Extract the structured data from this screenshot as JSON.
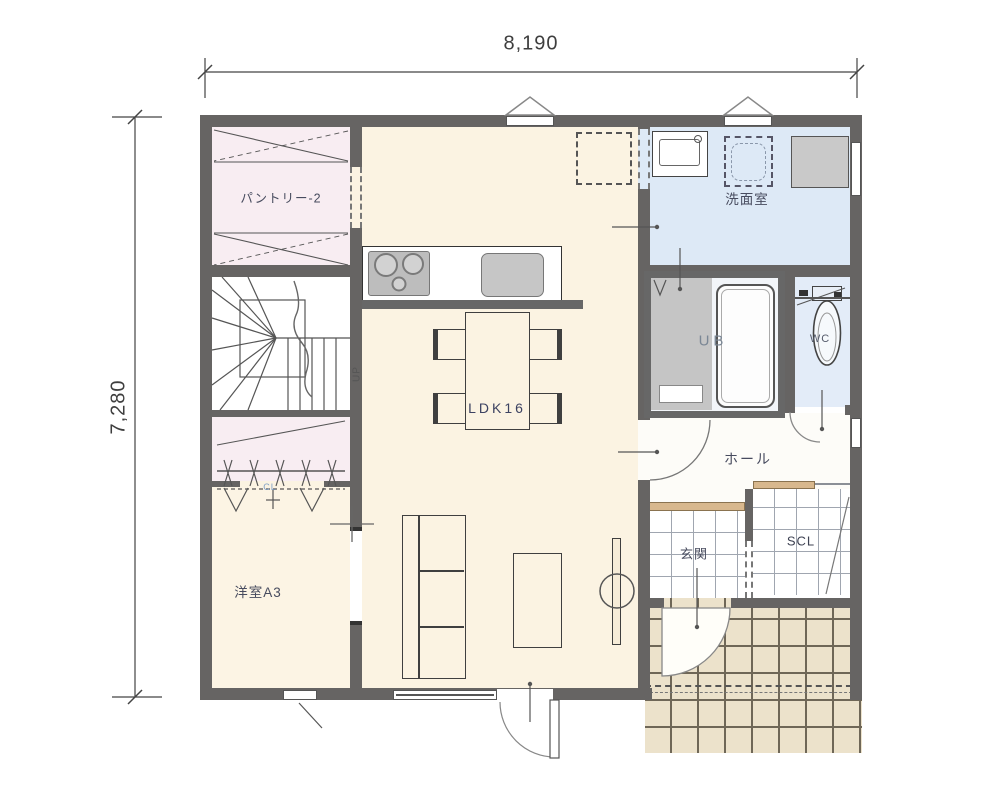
{
  "plan": {
    "dimensions": {
      "width_label": "8,190",
      "height_label": "7,280"
    },
    "labels": {
      "pantry": "パントリー-2",
      "up": "UP",
      "cl": "CL",
      "bedroom": "洋室A3",
      "ldk": "LDK16",
      "washroom": "洗面室",
      "bath": "UB",
      "wc": "WC",
      "hall": "ホール",
      "entrance": "玄関",
      "shoe_closet": "SCL"
    },
    "colors": {
      "wall": "#666463",
      "ldk_floor": "#fbf3e2",
      "bedroom_floor": "#fcf4e4",
      "pantry_floor": "#f8edf2",
      "wet_room_floor": "#dde9f6",
      "porch_tile": "#ece2cb",
      "entry_step": "#d8b88e",
      "label_text": "#474b5e"
    }
  }
}
